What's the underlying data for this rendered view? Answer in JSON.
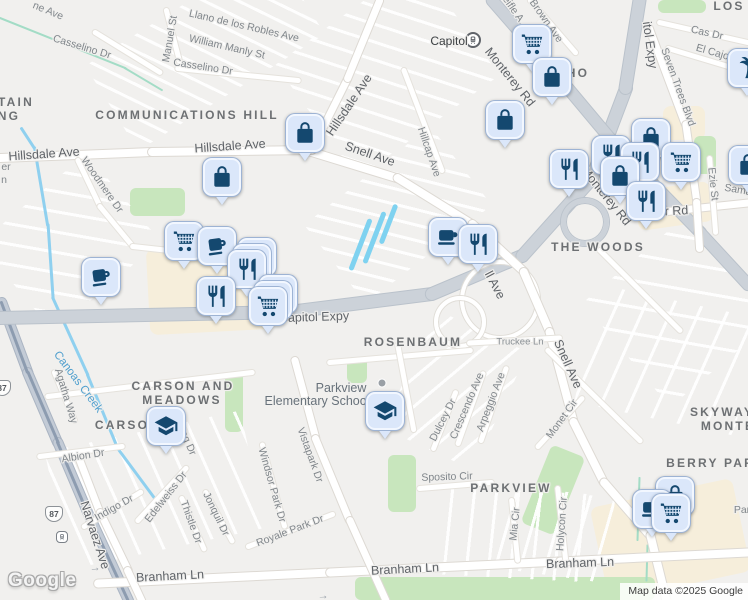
{
  "map": {
    "watermark": "Google",
    "attribution": "Map data ©2025 Google",
    "colors": {
      "marker_fill": "#dbe7fa",
      "marker_icon": "#14486f",
      "park_green": "#c8e6bd",
      "commercial_cream": "#f6eedb",
      "water_blue": "#7fd2f0",
      "highway_gray": "#ccd2d9",
      "background": "#f1f0ee"
    },
    "labels": [
      {
        "t": "ne Ave",
        "x": 48,
        "y": 11,
        "r": 22,
        "c": "st"
      },
      {
        "t": "Casselino Dr",
        "x": 82,
        "y": 47,
        "r": 17,
        "c": "st"
      },
      {
        "t": "Manuel St",
        "x": 170,
        "y": 39,
        "r": -80,
        "c": "st"
      },
      {
        "t": "Llano de los Robles Ave",
        "x": 244,
        "y": 26,
        "r": 13,
        "c": "st"
      },
      {
        "t": "William Manly St",
        "x": 227,
        "y": 47,
        "r": 13,
        "c": "st"
      },
      {
        "t": "Casselino Dr",
        "x": 203,
        "y": 67,
        "r": 9,
        "c": "st"
      },
      {
        "t": "TAIN",
        "x": 16,
        "y": 102,
        "r": 0,
        "c": "hood"
      },
      {
        "t": "NG",
        "x": 9,
        "y": 116,
        "r": 0,
        "c": "hood"
      },
      {
        "t": "COMMUNICATIONS HILL",
        "x": 187,
        "y": 115,
        "r": 0,
        "c": "hood"
      },
      {
        "t": "Hillsdale Ave",
        "x": 44,
        "y": 154,
        "r": -4,
        "c": "stlg"
      },
      {
        "t": "Hillsdale Ave",
        "x": 230,
        "y": 146,
        "r": -4,
        "c": "stlg"
      },
      {
        "t": "Hillsdale Ave",
        "x": 349,
        "y": 105,
        "r": -56,
        "c": "stlg"
      },
      {
        "t": "Snell Ave",
        "x": 370,
        "y": 154,
        "r": 19,
        "c": "stlg"
      },
      {
        "t": "Hillcap Ave",
        "x": 429,
        "y": 152,
        "r": 71,
        "c": "st"
      },
      {
        "t": "eifle A",
        "x": 513,
        "y": 9,
        "r": 55,
        "c": "st"
      },
      {
        "t": "Brown Ave",
        "x": 546,
        "y": 21,
        "r": 55,
        "c": "st"
      },
      {
        "t": "Monterey Rd",
        "x": 510,
        "y": 77,
        "r": 51,
        "c": "stlg"
      },
      {
        "t": "Monterey Rd",
        "x": 606,
        "y": 196,
        "r": 51,
        "c": "stlg"
      },
      {
        "t": "itol Expy",
        "x": 650,
        "y": 45,
        "r": 82,
        "c": "stlg"
      },
      {
        "t": "LOS",
        "x": 729,
        "y": 6,
        "r": 0,
        "c": "hood"
      },
      {
        "t": "Cas Dr",
        "x": 707,
        "y": 33,
        "r": 13,
        "c": "st"
      },
      {
        "t": "El Cajon Dr",
        "x": 722,
        "y": 55,
        "r": 16,
        "c": "st"
      },
      {
        "t": "Seven Trees Blvd",
        "x": 678,
        "y": 87,
        "r": 70,
        "c": "st"
      },
      {
        "t": "HO",
        "x": 578,
        "y": 73,
        "r": 0,
        "c": "hood"
      },
      {
        "t": "Ezie St",
        "x": 713,
        "y": 184,
        "r": 84,
        "c": "st"
      },
      {
        "t": "Sama",
        "x": 738,
        "y": 190,
        "r": 10,
        "c": "st"
      },
      {
        "t": "er Rd",
        "x": 673,
        "y": 211,
        "r": -3,
        "c": "stlg"
      },
      {
        "t": "THE WOODS",
        "x": 598,
        "y": 247,
        "r": 0,
        "c": "hood"
      },
      {
        "t": "er",
        "x": 6,
        "y": 167,
        "r": 0,
        "c": "st"
      },
      {
        "t": "n",
        "x": 4,
        "y": 180,
        "r": 0,
        "c": "st"
      },
      {
        "t": "Woodmere Dr",
        "x": 102,
        "y": 185,
        "r": 55,
        "c": "st"
      },
      {
        "t": "ll Ave",
        "x": 495,
        "y": 285,
        "r": 62,
        "c": "stlg"
      },
      {
        "t": "Snell Ave",
        "x": 568,
        "y": 364,
        "r": 66,
        "c": "stlg"
      },
      {
        "t": "Capitol Expy",
        "x": 314,
        "y": 317,
        "r": -2,
        "c": "stlg"
      },
      {
        "t": "ROSENBAUM",
        "x": 413,
        "y": 342,
        "r": 0,
        "c": "hood"
      },
      {
        "t": "Truckee Ln",
        "x": 520,
        "y": 342,
        "r": 0,
        "c": "stsm"
      },
      {
        "t": "Canoas Creek",
        "x": 78,
        "y": 382,
        "r": 53,
        "c": "water"
      },
      {
        "t": "Agatha Way",
        "x": 66,
        "y": 396,
        "r": 73,
        "c": "st"
      },
      {
        "t": "CARSON AND",
        "x": 183,
        "y": 386,
        "r": 0,
        "c": "hood"
      },
      {
        "t": "MEADOWS",
        "x": 182,
        "y": 400,
        "r": 0,
        "c": "hood"
      },
      {
        "t": "CARSO",
        "x": 122,
        "y": 425,
        "r": 0,
        "c": "hood"
      },
      {
        "t": "eg Dr",
        "x": 188,
        "y": 443,
        "r": 66,
        "c": "st"
      },
      {
        "t": "Albion Dr",
        "x": 83,
        "y": 456,
        "r": -9,
        "c": "st"
      },
      {
        "t": "Parkview",
        "x": 341,
        "y": 388,
        "r": 0,
        "c": "sch"
      },
      {
        "t": "Elementary School",
        "x": 317,
        "y": 401,
        "r": 0,
        "c": "sch"
      },
      {
        "t": "Vistapark Dr",
        "x": 310,
        "y": 455,
        "r": 70,
        "c": "st"
      },
      {
        "t": "Windsor Park Dr",
        "x": 272,
        "y": 485,
        "r": 74,
        "c": "st"
      },
      {
        "t": "Royale Park Dr",
        "x": 290,
        "y": 531,
        "r": -21,
        "c": "st"
      },
      {
        "t": "Indigo Dr",
        "x": 114,
        "y": 508,
        "r": -29,
        "c": "st"
      },
      {
        "t": "Edelweiss Dr",
        "x": 166,
        "y": 497,
        "r": -52,
        "c": "st"
      },
      {
        "t": "Thistle Dr",
        "x": 191,
        "y": 522,
        "r": 70,
        "c": "st"
      },
      {
        "t": "Jonquil Dr",
        "x": 216,
        "y": 514,
        "r": 64,
        "c": "st"
      },
      {
        "t": "Narvaez Ave",
        "x": 95,
        "y": 535,
        "r": 72,
        "c": "stlg"
      },
      {
        "t": "Branham Ln",
        "x": 170,
        "y": 576,
        "r": -3,
        "c": "stlg"
      },
      {
        "t": "Branham Ln",
        "x": 405,
        "y": 569,
        "r": -3,
        "c": "stlg"
      },
      {
        "t": "Branham Ln",
        "x": 580,
        "y": 563,
        "r": -2,
        "c": "stlg"
      },
      {
        "t": "Dulcey Dr",
        "x": 443,
        "y": 420,
        "r": -63,
        "c": "st"
      },
      {
        "t": "Crescendo Ave",
        "x": 467,
        "y": 406,
        "r": -67,
        "c": "st"
      },
      {
        "t": "Arpeggio Ave",
        "x": 491,
        "y": 402,
        "r": -69,
        "c": "st"
      },
      {
        "t": "Sposito Cir",
        "x": 447,
        "y": 477,
        "r": -2,
        "c": "st"
      },
      {
        "t": "PARKVIEW",
        "x": 511,
        "y": 488,
        "r": 0,
        "c": "hood"
      },
      {
        "t": "Monet Cir",
        "x": 562,
        "y": 419,
        "r": -54,
        "c": "st"
      },
      {
        "t": "Mia Cir",
        "x": 515,
        "y": 524,
        "r": -84,
        "c": "st"
      },
      {
        "t": "Holycon Cir",
        "x": 562,
        "y": 524,
        "r": -86,
        "c": "st"
      },
      {
        "t": "SKYWAY",
        "x": 722,
        "y": 412,
        "r": 0,
        "c": "hood"
      },
      {
        "t": "MONTE",
        "x": 728,
        "y": 426,
        "r": 0,
        "c": "hood"
      },
      {
        "t": "BERRY PARK",
        "x": 716,
        "y": 463,
        "r": 0,
        "c": "hood"
      },
      {
        "t": "Par",
        "x": 742,
        "y": 510,
        "r": 0,
        "c": "st"
      },
      {
        "t": "→",
        "x": 95,
        "y": 568,
        "r": -5,
        "c": "arrow"
      },
      {
        "t": "→",
        "x": 323,
        "y": 596,
        "r": -3,
        "c": "arrow"
      }
    ],
    "transit": {
      "station_label": "Capitol",
      "station_label_x": 449,
      "station_label_y": 41,
      "station_icon_x": 473,
      "station_icon_y": 40,
      "stop_icon_x": 62,
      "stop_icon_y": 537
    },
    "shields": [
      {
        "label": "87",
        "x": 54,
        "y": 514
      },
      {
        "label": "87",
        "x": 2,
        "y": 388
      }
    ],
    "poi_dots": [
      {
        "x": 382,
        "y": 383
      }
    ],
    "markers": [
      {
        "icon": "shopping-cart",
        "x": 532,
        "y": 44
      },
      {
        "icon": "shopping-bag",
        "x": 552,
        "y": 77
      },
      {
        "icon": "shopping-bag",
        "x": 505,
        "y": 120
      },
      {
        "icon": "shopping-bag",
        "x": 305,
        "y": 133
      },
      {
        "icon": "shopping-bag",
        "x": 222,
        "y": 177
      },
      {
        "icon": "shopping-bag",
        "x": 651,
        "y": 138
      },
      {
        "icon": "restaurant",
        "x": 611,
        "y": 155
      },
      {
        "icon": "restaurant",
        "x": 640,
        "y": 162
      },
      {
        "icon": "shopping-cart",
        "x": 681,
        "y": 162
      },
      {
        "icon": "restaurant",
        "x": 569,
        "y": 169
      },
      {
        "icon": "shopping-bag",
        "x": 620,
        "y": 176
      },
      {
        "icon": "restaurant",
        "x": 646,
        "y": 201
      },
      {
        "icon": "palm-tree",
        "x": 747,
        "y": 68
      },
      {
        "icon": "shopping-bag",
        "x": 748,
        "y": 165
      },
      {
        "icon": "coffee-cup",
        "x": 101,
        "y": 277
      },
      {
        "icon": "shopping-cart",
        "x": 184,
        "y": 241
      },
      {
        "icon": "coffee-cup",
        "x": 217,
        "y": 246
      },
      {
        "icon": "restaurant",
        "x": 247,
        "y": 269,
        "stack": 3
      },
      {
        "icon": "restaurant",
        "x": 216,
        "y": 296
      },
      {
        "icon": "shopping-cart",
        "x": 268,
        "y": 306,
        "stack": 3
      },
      {
        "icon": "cafe",
        "x": 448,
        "y": 237
      },
      {
        "icon": "restaurant",
        "x": 478,
        "y": 244
      },
      {
        "icon": "school",
        "x": 166,
        "y": 426
      },
      {
        "icon": "school",
        "x": 385,
        "y": 411
      },
      {
        "icon": "shopping-bag",
        "x": 675,
        "y": 496
      },
      {
        "icon": "cafe",
        "x": 652,
        "y": 509
      },
      {
        "icon": "shopping-cart",
        "x": 671,
        "y": 513
      }
    ]
  }
}
